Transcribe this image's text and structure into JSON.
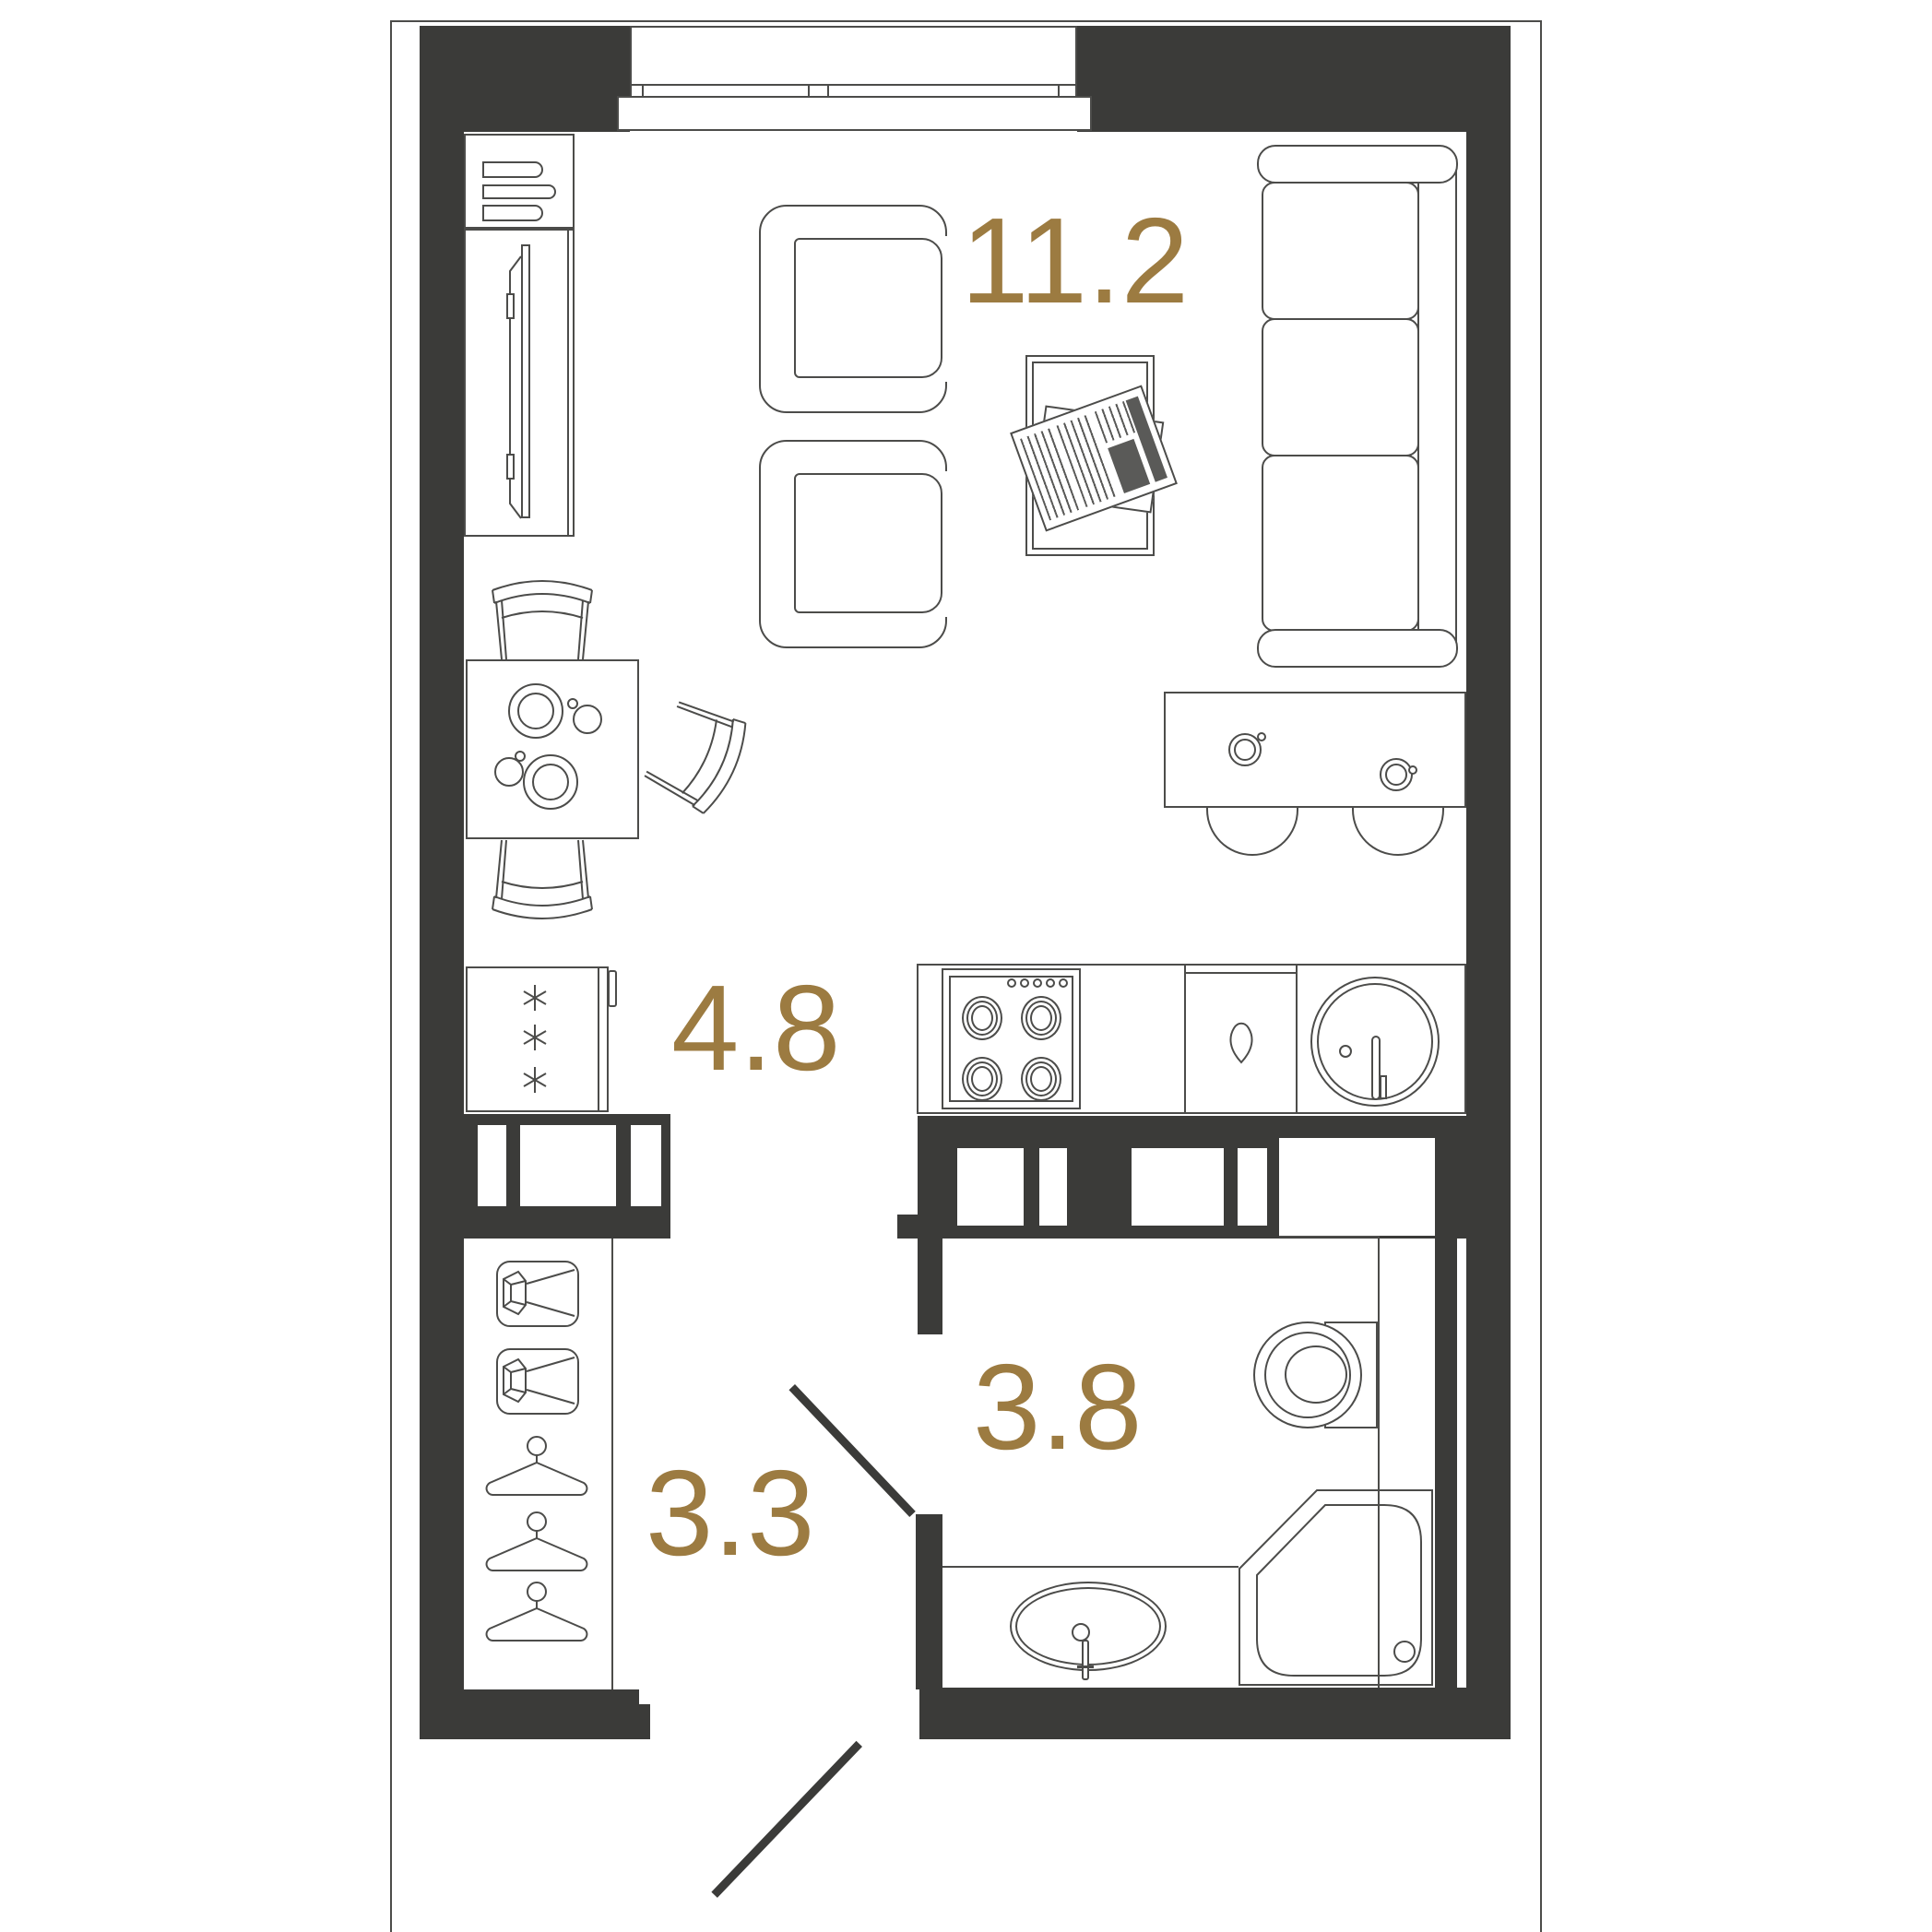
{
  "palette": {
    "wall_color": "#3b3b39",
    "line_color": "#4c4c4a",
    "label_color": "#9c7b41",
    "newspaper_gray": "#5a5a58",
    "background": "#ffffff"
  },
  "plan": {
    "type": "studio-apartment-floor-plan",
    "rooms": [
      {
        "name": "living-room",
        "area_label": "11.2"
      },
      {
        "name": "kitchen",
        "area_label": "4.8"
      },
      {
        "name": "hallway",
        "area_label": "3.3"
      },
      {
        "name": "bathroom",
        "area_label": "3.8"
      }
    ],
    "icons": [
      "window",
      "tv-cabinet",
      "tv",
      "armchair",
      "coffee-table",
      "newspaper",
      "sofa",
      "bar-counter",
      "bar-stool",
      "coffee-cup",
      "dining-table",
      "plate",
      "cup",
      "chair",
      "fridge",
      "snowflake",
      "stove",
      "burner",
      "dishwasher",
      "water-drop",
      "kitchen-sink",
      "faucet",
      "glazed-partition",
      "wardrobe-spotlight",
      "clothes-hanger",
      "toilet",
      "vanity-sink",
      "shower-tray",
      "door-leaf"
    ]
  }
}
